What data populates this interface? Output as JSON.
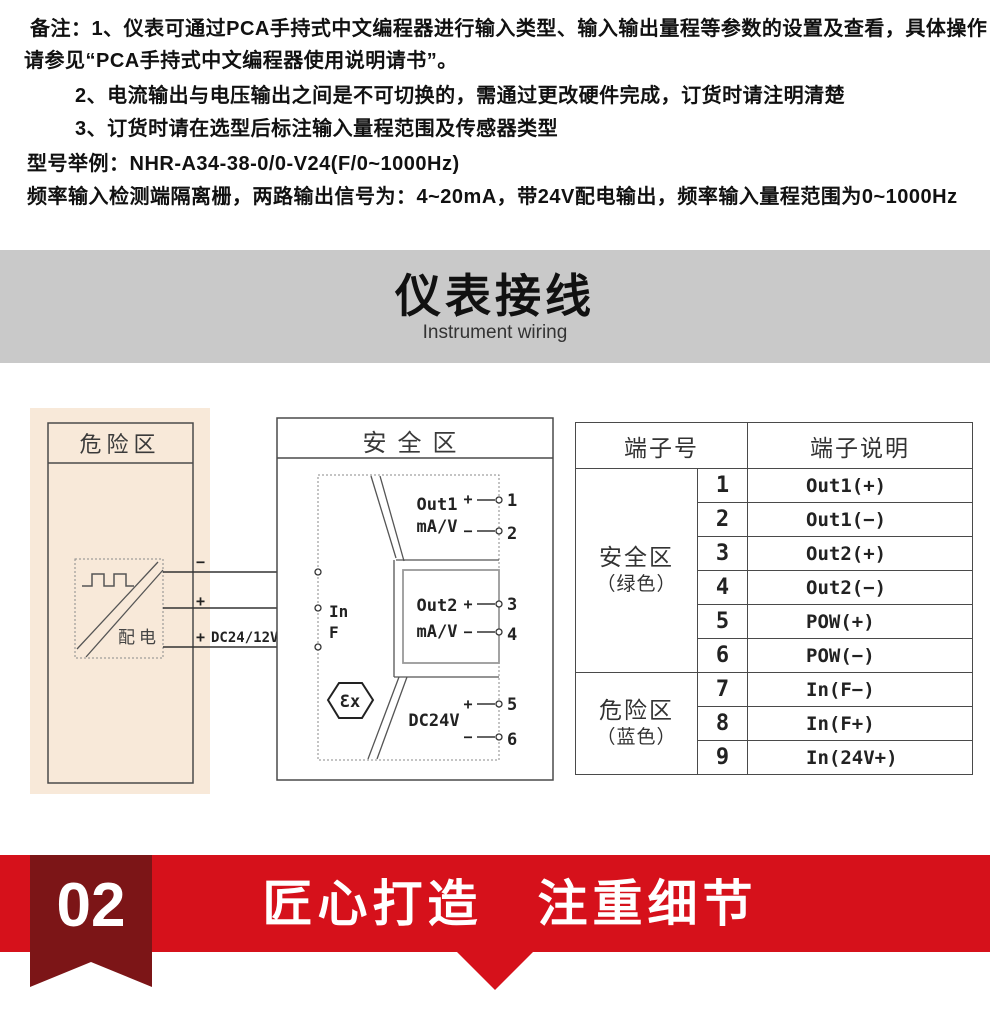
{
  "notes": {
    "line1": "备注：1、仪表可通过PCA手持式中文编程器进行输入类型、输入输出量程等参数的设置及查看，具体操作",
    "line2": "请参见“PCA手持式中文编程器使用说明请书”。",
    "line3": "2、电流输出与电压输出之间是不可切换的，需通过更改硬件完成，订货时请注明清楚",
    "line4": "3、订货时请在选型后标注输入量程范围及传感器类型",
    "line5": "型号举例：NHR-A34-38-0/0-V24(F/0~1000Hz)",
    "line6": "频率输入检测端隔离栅，两路输出信号为：4~20mA，带24V配电输出，频率输入量程范围为0~1000Hz"
  },
  "section_banner": {
    "title": "仪表接线",
    "subtitle": "Instrument wiring",
    "background": "#c9c9c9"
  },
  "wiring": {
    "hazard_zone_title": "危险区",
    "safe_zone_title": "安全区",
    "power_label": "配电",
    "input_lines": [
      {
        "polarity": "−",
        "terminal": "7"
      },
      {
        "polarity": "+",
        "terminal": "8"
      },
      {
        "polarity": "+",
        "label": "DC24/12V",
        "terminal": "9"
      }
    ],
    "input_label": "In",
    "input_type": "F",
    "ex_mark": "Ɛx",
    "blocks": [
      {
        "name": "Out1",
        "unit": "mA/V"
      },
      {
        "name": "Out2",
        "unit": "mA/V"
      },
      {
        "name": "DC24V"
      }
    ],
    "output_terminals": [
      {
        "sign": "+",
        "num": "1"
      },
      {
        "sign": "−",
        "num": "2"
      },
      {
        "sign": "+",
        "num": "3"
      },
      {
        "sign": "−",
        "num": "4"
      },
      {
        "sign": "+",
        "num": "5"
      },
      {
        "sign": "−",
        "num": "6"
      }
    ]
  },
  "terminal_table": {
    "headers": [
      "端子号",
      "端子说明"
    ],
    "groups": [
      {
        "zone": "安全区",
        "color_note": "（绿色）",
        "rows": [
          {
            "num": "1",
            "desc": "Out1(+)"
          },
          {
            "num": "2",
            "desc": "Out1(−)"
          },
          {
            "num": "3",
            "desc": "Out2(+)"
          },
          {
            "num": "4",
            "desc": "Out2(−)"
          },
          {
            "num": "5",
            "desc": "POW(+)"
          },
          {
            "num": "6",
            "desc": "POW(−)"
          }
        ]
      },
      {
        "zone": "危险区",
        "color_note": "（蓝色）",
        "rows": [
          {
            "num": "7",
            "desc": "In(F−)"
          },
          {
            "num": "8",
            "desc": "In(F+)"
          },
          {
            "num": "9",
            "desc": "In(24V+)"
          }
        ]
      }
    ]
  },
  "footer": {
    "badge": "02",
    "slogan": "匠心打造　注重细节",
    "band_color": "#d6111b",
    "ribbon_color": "#7c1517"
  }
}
